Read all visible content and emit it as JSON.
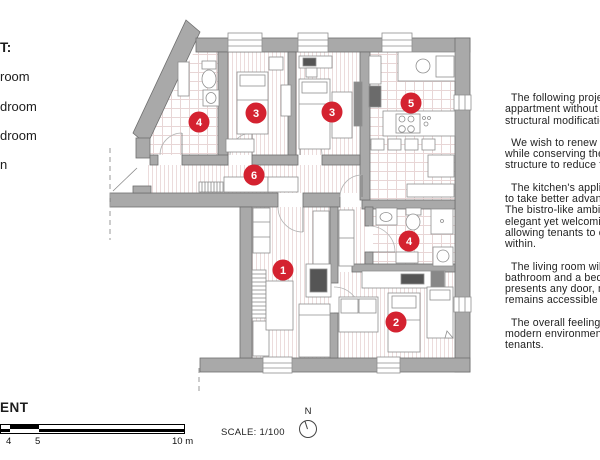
{
  "legend": {
    "heading_fragment": "T:",
    "items": [
      "room",
      "droom",
      "droom",
      "n"
    ]
  },
  "description": {
    "paragraphs": [
      [
        "  The following projec",
        "appartment without re",
        "structural modification"
      ],
      [
        "  We wish to renew the",
        "while conserving the ai",
        "structure to reduce the"
      ],
      [
        "  The kitchen's applian",
        "to take better advanta",
        "The bistro-like ambian",
        "elegant yet welcoming",
        "allowing tenants to co-",
        "within."
      ],
      [
        "  The living room will b",
        "bathroom and a bedro",
        "presents any door, me",
        "remains accessible by"
      ],
      [
        "  The overall feeling is",
        "modern environment fo",
        "tenants."
      ]
    ]
  },
  "plan": {
    "marker_color": "#d42230",
    "wall_color": "#a9a9a9",
    "markers": [
      {
        "num": "1"
      },
      {
        "num": "2"
      },
      {
        "num": "3"
      },
      {
        "num": "3"
      },
      {
        "num": "4"
      },
      {
        "num": "4"
      },
      {
        "num": "5"
      },
      {
        "num": "6"
      }
    ]
  },
  "footer": {
    "title_fragment": "ENT",
    "scale_text": "SCALE: 1/100",
    "north_label": "N",
    "ticks": [
      "4",
      "5",
      "10 m"
    ]
  }
}
